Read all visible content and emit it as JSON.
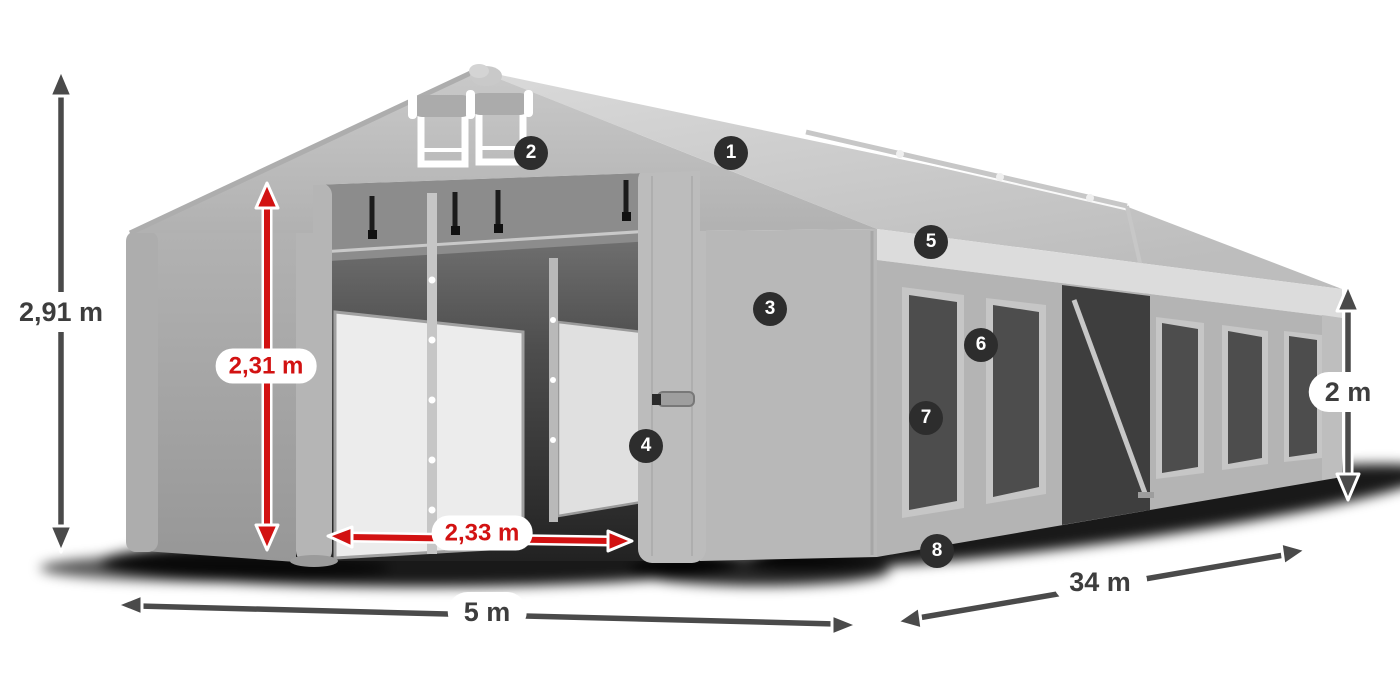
{
  "diagram": {
    "dimensions": {
      "total_height": "2,91 m",
      "door_height": "2,31 m",
      "door_width": "2,33 m",
      "front_width": "5 m",
      "side_length": "34 m",
      "side_wall_height": "2 m"
    },
    "callouts": [
      "1",
      "2",
      "3",
      "4",
      "5",
      "6",
      "7",
      "8"
    ],
    "colors": {
      "dimension_red": "#d21212",
      "dimension_gray": "#4a4a4a",
      "badge_background": "#2d2d2d",
      "badge_text": "#ffffff",
      "label_background": "#ffffff",
      "label_text": "#3d3d3d",
      "tent_roof": "#cfcfcf",
      "tent_wall": "#b4b4b4",
      "tent_window": "#4d4d4d",
      "shadow": "#000000"
    }
  }
}
